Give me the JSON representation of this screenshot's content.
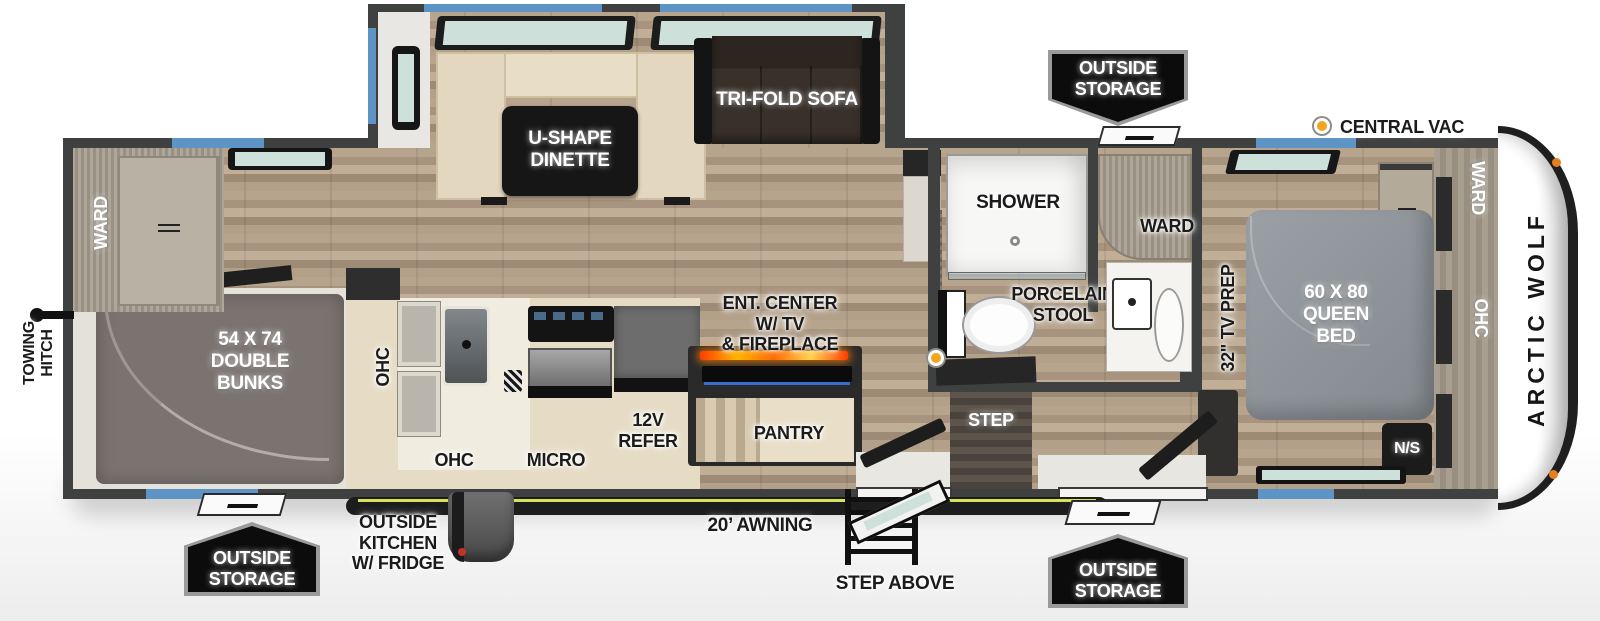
{
  "brand": {
    "name": "ARCTIC WOLF"
  },
  "legend": {
    "central_vac": "CENTRAL VAC"
  },
  "exterior": {
    "towing_hitch": "TOWING\nHITCH",
    "outside_storage": "OUTSIDE\nSTORAGE",
    "outside_kitchen": "OUTSIDE\nKITCHEN\nW/ FRIDGE",
    "awning": "20’ AWNING",
    "step_above": "STEP ABOVE"
  },
  "living_area": {
    "dinette": "U-SHAPE\nDINETTE",
    "sofa": "TRI-FOLD SOFA",
    "ent_center": "ENT. CENTER\nW/ TV\n& FIREPLACE",
    "pantry": "PANTRY"
  },
  "kitchen": {
    "ohc_vertical": "OHC",
    "ohc": "OHC",
    "micro": "MICRO",
    "refer": "12V\nREFER"
  },
  "bunk_room": {
    "ward": "WARD",
    "bunks": "54 X 74\nDOUBLE\nBUNKS"
  },
  "bathroom": {
    "shower": "SHOWER",
    "porcelain_stool": "PORCELAIN\nSTOOL",
    "ward": "WARD",
    "step": "STEP"
  },
  "bedroom": {
    "tv_prep": "32\" TV PREP",
    "queen_bed": "60 X 80\nQUEEN\nBED",
    "night_stand": "N/S",
    "ward": "WARD",
    "ohc": "OHC"
  },
  "colors": {
    "accent_blue": "#5e93c6",
    "awning_stripe": "#d9e154",
    "central_vac_orange": "#f2a41c",
    "fireplace_orange": "#ff7a00"
  }
}
